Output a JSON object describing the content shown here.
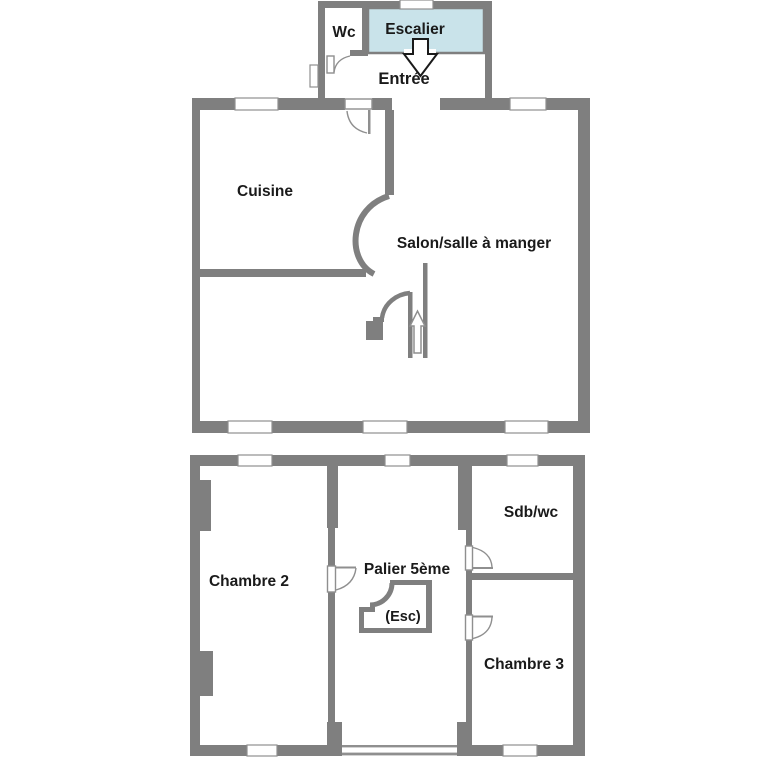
{
  "plan": {
    "type": "floor-plan",
    "language": "fr",
    "upper_floor": {
      "rooms": {
        "wc": "Wc",
        "escalier": "Escalier",
        "entree": "Entrée",
        "cuisine": "Cuisine",
        "salon": "Salon/salle à manger"
      },
      "features": [
        "stairs-down-arrow",
        "internal-stairs-up-arrow",
        "curved-passage-cuisine-salon"
      ]
    },
    "lower_floor": {
      "rooms": {
        "chambre2": "Chambre 2",
        "palier": "Palier 5ème",
        "esc": "(Esc)",
        "sdb": "Sdb/wc",
        "chambre3": "Chambre 3"
      },
      "features": [
        "stair-enclosure",
        "chimney-breasts",
        "long-window-palier"
      ]
    }
  },
  "colors": {
    "background": "#ffffff",
    "wall": "#7f7f7f",
    "stair_highlight": "#c9e3ea",
    "stair_highlight_border": "#7f7f7f",
    "window_fill": "#ffffff",
    "window_outline": "#8f8f8f",
    "door_outline": "#8f8f8f",
    "text": "#1a1a1a",
    "arrow_down_outline": "#1a1a1a",
    "arrow_up_outline": "#8f8f8f",
    "arrow_fill": "#ffffff"
  }
}
